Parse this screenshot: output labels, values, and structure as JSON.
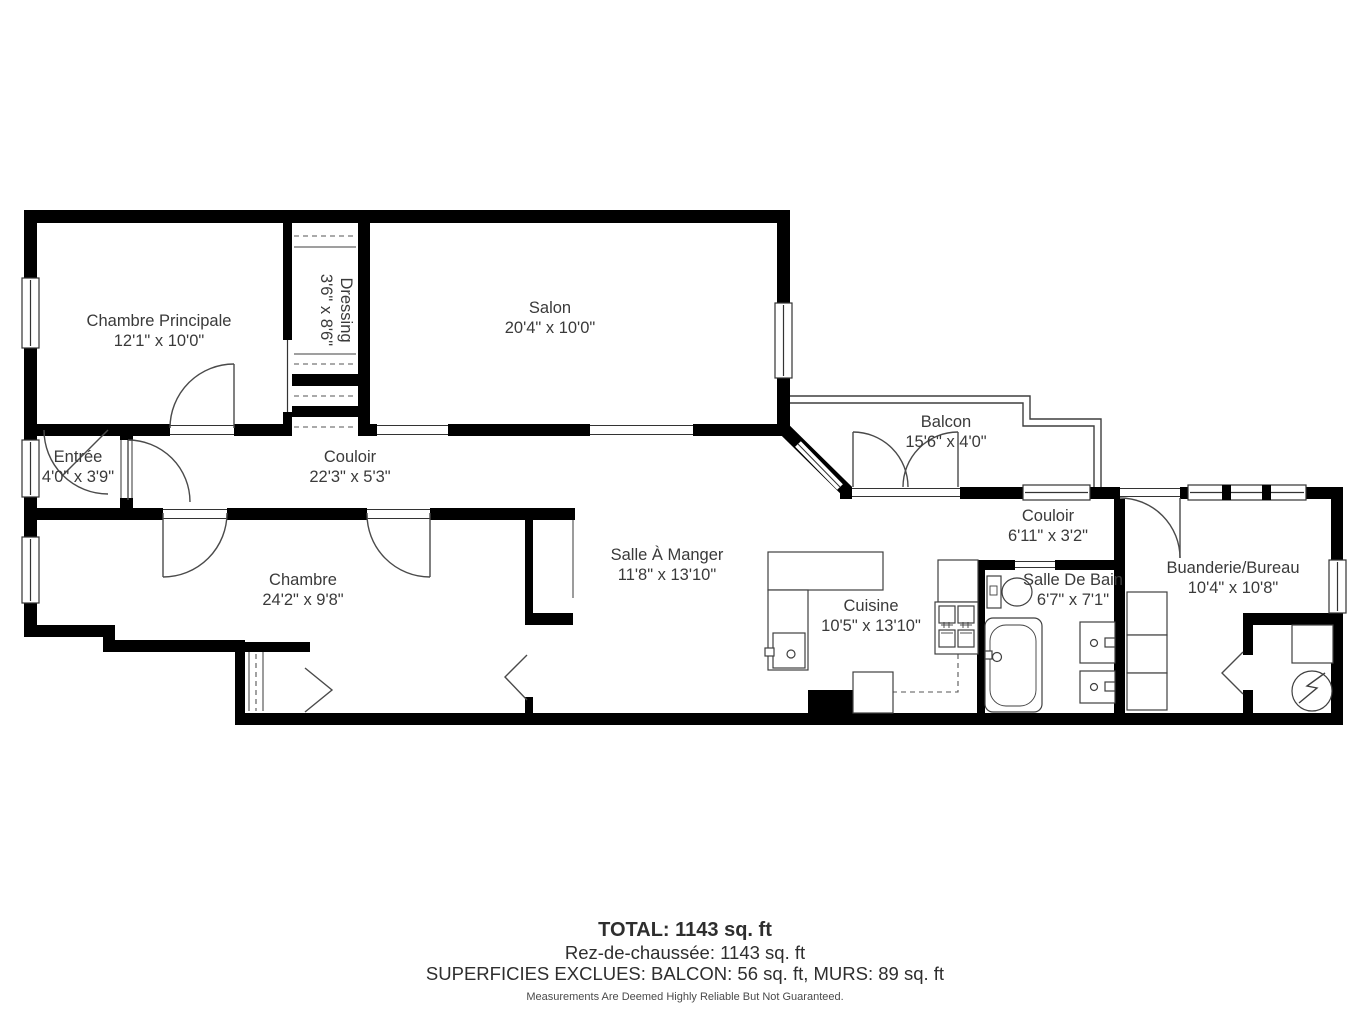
{
  "rooms": [
    {
      "name": "Chambre Principale",
      "dims": "12'1\" x 10'0\""
    },
    {
      "name": "Dressing",
      "dims": "3'6\" x 8'6\""
    },
    {
      "name": "Salon",
      "dims": "20'4\" x 10'0\""
    },
    {
      "name": "Entrée",
      "dims": "4'0\" x 3'9\""
    },
    {
      "name": "Couloir",
      "dims": "22'3\" x 5'3\""
    },
    {
      "name": "Balcon",
      "dims": "15'6\" x 4'0\""
    },
    {
      "name": "Chambre",
      "dims": "24'2\" x 9'8\""
    },
    {
      "name": "Salle À Manger",
      "dims": "11'8\" x 13'10\""
    },
    {
      "name": "Cuisine",
      "dims": "10'5\" x 13'10\""
    },
    {
      "name": "Couloir",
      "dims": "6'11\" x 3'2\""
    },
    {
      "name": "Salle De Bain",
      "dims": "6'7\" x 7'1\""
    },
    {
      "name": "Buanderie/Bureau",
      "dims": "10'4\" x 10'8\""
    }
  ],
  "summary": {
    "total": "TOTAL: 1143 sq. ft",
    "floor": "Rez-de-chaussée: 1143 sq. ft",
    "excluded": "SUPERFICIES EXCLUES: BALCON: 56 sq. ft, MURS: 89 sq. ft",
    "disclaimer": "Measurements Are Deemed Highly Reliable But Not Guaranteed."
  },
  "colors": {
    "wall": "#000000",
    "line": "#3f3f3f",
    "text": "#3a3a3a"
  }
}
